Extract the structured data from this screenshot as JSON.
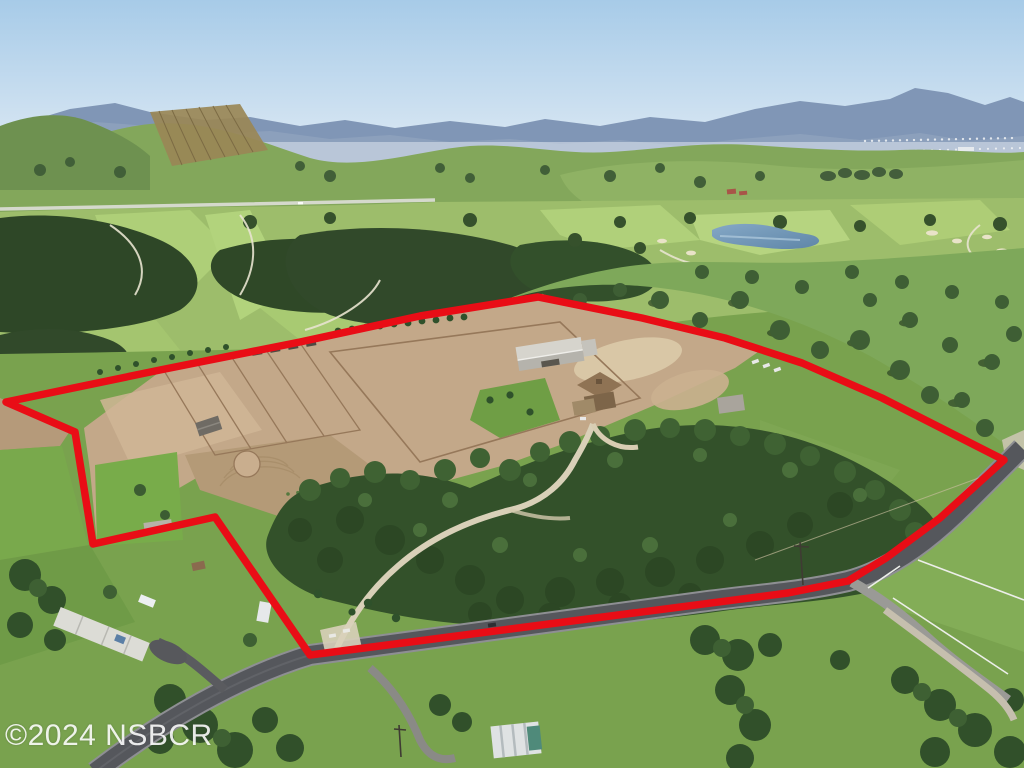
{
  "scene": {
    "kind": "aerial-photo",
    "subject": "Aerial view of ranch estate outlined with red property boundary, golf course, oak woodland and mountains beyond"
  },
  "watermark": {
    "text": "©2024 NSBCR",
    "color": "#ffffff"
  },
  "boundary": {
    "color": "#e90d16",
    "stroke_width": 7.5,
    "points": [
      [
        6,
        402
      ],
      [
        160,
        370
      ],
      [
        300,
        342
      ],
      [
        420,
        316
      ],
      [
        538,
        297
      ],
      [
        642,
        318
      ],
      [
        725,
        338
      ],
      [
        802,
        363
      ],
      [
        882,
        398
      ],
      [
        1004,
        460
      ],
      [
        940,
        518
      ],
      [
        886,
        558
      ],
      [
        848,
        581
      ],
      [
        788,
        593
      ],
      [
        310,
        655
      ],
      [
        215,
        517
      ],
      [
        93,
        544
      ],
      [
        75,
        432
      ]
    ]
  },
  "palette": {
    "sky_top": "#a7cbe8",
    "sky_horizon": "#e2ecf5",
    "mountains": "#8096b6",
    "haze": "#dfe6ee",
    "hills": "#83a75b",
    "fairway": "#a8c972",
    "woodland": "#33512a",
    "dirt": "#c3a889",
    "lawn": "#78ac4a",
    "pond": "#7095b6",
    "asphalt": "#55575c",
    "gravel": "#cbc4b2"
  }
}
